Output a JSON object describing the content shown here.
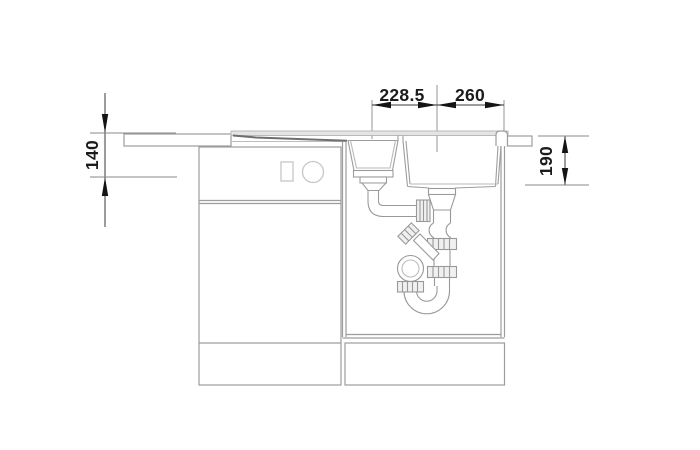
{
  "drawing": {
    "description": "Technical side-view installation drawing of a kitchen sink with small and main bowl, base cabinets and drain trap",
    "dimensions": {
      "top_left_label": "228.5",
      "top_right_label": "260",
      "left_label": "140",
      "right_label": "190"
    },
    "colors": {
      "outline": "#9d9d9d",
      "dimension_line": "#3a3a3a",
      "arrow": "#141414",
      "extension_line": "#8a8a8a",
      "surface_fill": "#e4e4e4",
      "text": "#1c1c1c"
    }
  }
}
